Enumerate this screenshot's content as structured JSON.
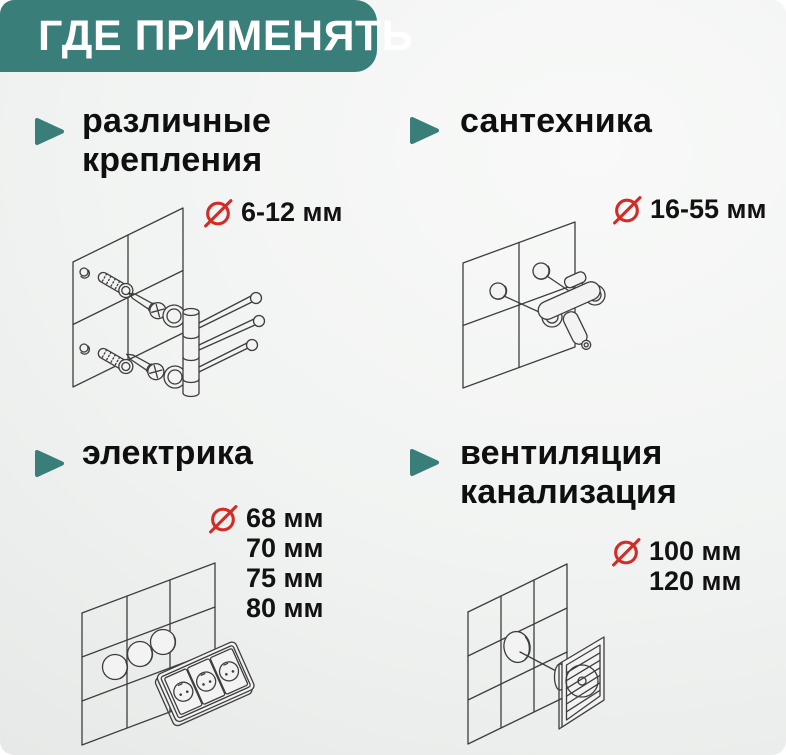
{
  "header": {
    "title": "ГДЕ ПРИМЕНЯТЬ"
  },
  "colors": {
    "accent_teal": "#3A7E7A",
    "diameter_red": "#D32B25",
    "text_dark": "#121212",
    "line_gray": "#3D3D3D",
    "background": "#F2F3F2"
  },
  "sections": [
    {
      "id": "fasteners",
      "title_lines": [
        "различные",
        "крепления"
      ],
      "sizes": [
        "6-12 мм"
      ],
      "illustration": "dowels-screws-and-towel-rail-on-tiles"
    },
    {
      "id": "plumbing",
      "title_lines": [
        "сантехника"
      ],
      "sizes": [
        "16-55 мм"
      ],
      "illustration": "wall-mixer-tap-on-tiles"
    },
    {
      "id": "electrical",
      "title_lines": [
        "электрика"
      ],
      "sizes": [
        "68 мм",
        "70 мм",
        "75 мм",
        "80 мм"
      ],
      "illustration": "triple-socket-and-drilled-holes"
    },
    {
      "id": "ventilation",
      "title_lines": [
        "вентиляция",
        "канализация"
      ],
      "sizes": [
        "100 мм",
        "120 мм"
      ],
      "illustration": "vent-grille-and-round-hole"
    }
  ]
}
